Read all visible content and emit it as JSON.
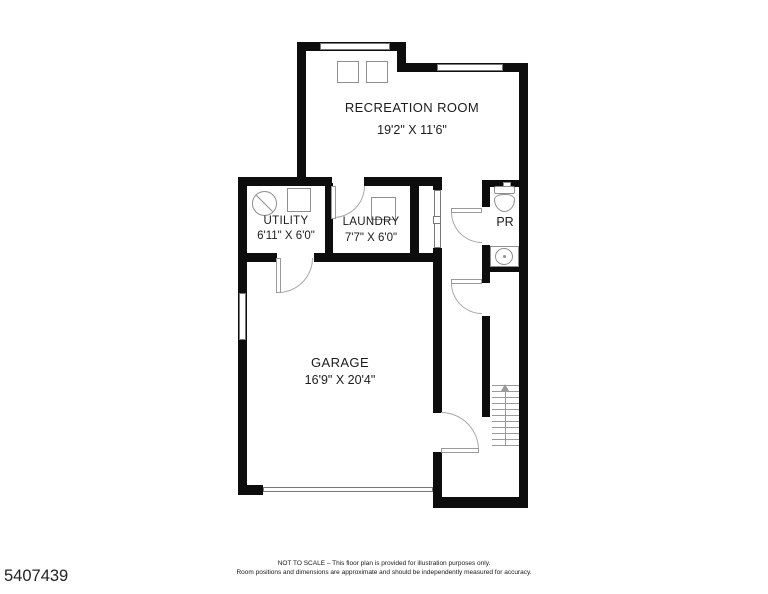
{
  "plan": {
    "listing_id": "5407439",
    "rooms": {
      "recreation": {
        "label": "RECREATION ROOM",
        "dims": "19'2\" X 11'6\""
      },
      "utility": {
        "label": "UTILITY",
        "dims": "6'11\" X 6'0\""
      },
      "laundry": {
        "label": "LAUNDRY",
        "dims": "7'7\" X 6'0\""
      },
      "powder_room": {
        "label": "PR"
      },
      "garage": {
        "label": "GARAGE",
        "dims": "16'9\" X 20'4\""
      }
    },
    "footer": {
      "line1": "NOT TO SCALE – This floor plan is provided for illustration purposes only.",
      "line2": "Room positions and dimensions are approximate and should be independently measured for accuracy."
    },
    "colors": {
      "wall": "#0d0d0d",
      "fixture_line": "#8f8f8f",
      "background": "#ffffff"
    },
    "symbols": [
      "stairs-up-arrow-icon",
      "water-heater-icon",
      "toilet-icon",
      "sink-icon",
      "washer-box-icon",
      "door-swing-icon",
      "window-icon",
      "garage-door-icon"
    ]
  }
}
